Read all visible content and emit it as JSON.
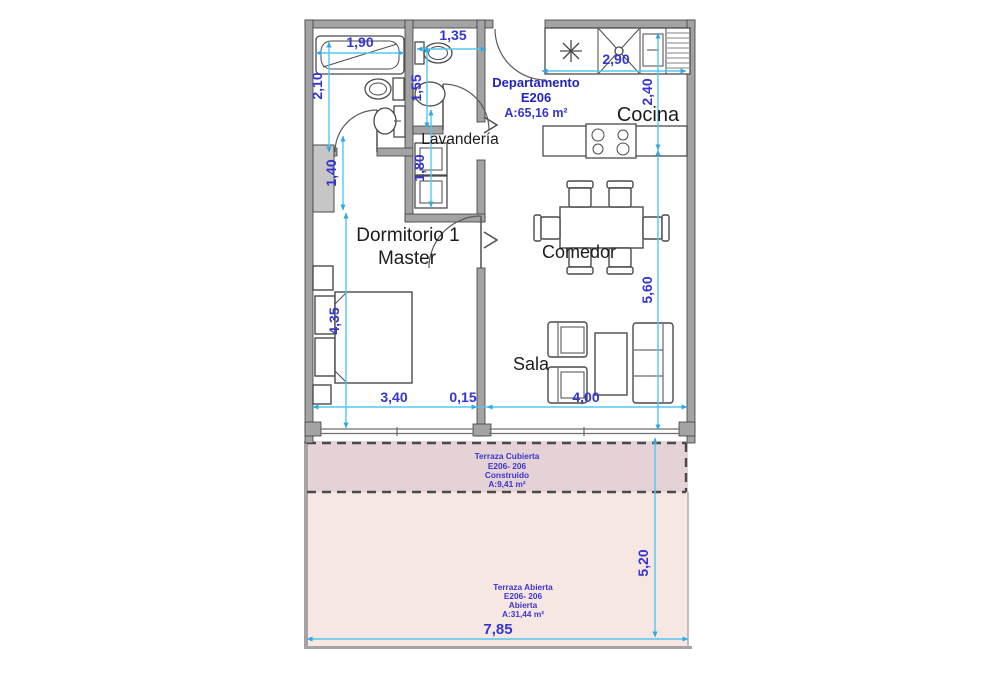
{
  "unit_label": {
    "line1": "Departamento",
    "line2": "E206",
    "area": "A:65,16 m²"
  },
  "rooms": {
    "cocina": {
      "label": "Cocina"
    },
    "lavanderia": {
      "label": "Lavandería"
    },
    "dormitorio": {
      "line1": "Dormitorio 1",
      "line2": "Master"
    },
    "comedor": {
      "label": "Comedor"
    },
    "sala": {
      "label": "Sala"
    }
  },
  "terraces": {
    "cubierta": {
      "line1": "Terraza Cubierta",
      "line2": "E206- 206",
      "line3": "Construido",
      "line4": "A:9,41 m²"
    },
    "abierta": {
      "line1": "Terraza Abierta",
      "line2": "E206- 206",
      "line3": "Abierta",
      "line4": "A:31,44 m²"
    }
  },
  "dimensions": {
    "bathtub_width": "1,90",
    "bathroom2_width": "1,35",
    "kitchen_width": "2,90",
    "bathroom1_depth": "2,10",
    "bathroom2_depth": "1,55",
    "kitchen_depth": "2,40",
    "closet_width": "1,40",
    "laundry_depth": "1,80",
    "bedroom_depth": "4,35",
    "living_depth": "5,60",
    "bedroom_width": "3,40",
    "wall_thickness": "0,15",
    "living_width": "4,00",
    "terrace_depth": "5,20",
    "terrace_width": "7,85"
  },
  "colors": {
    "dimension_line": "#54c7f0",
    "dimension_arrow": "#2fa9df",
    "dimension_text": "#3535cf",
    "unit_label_text": "#2323bb",
    "wall_fill": "#a3a3a3",
    "terrace_covered_fill": "#e4d2d7",
    "terrace_open_fill": "#f7e7e3"
  },
  "symbols": {
    "appliance_asterisk": "✳",
    "passage_arrow": ">"
  }
}
